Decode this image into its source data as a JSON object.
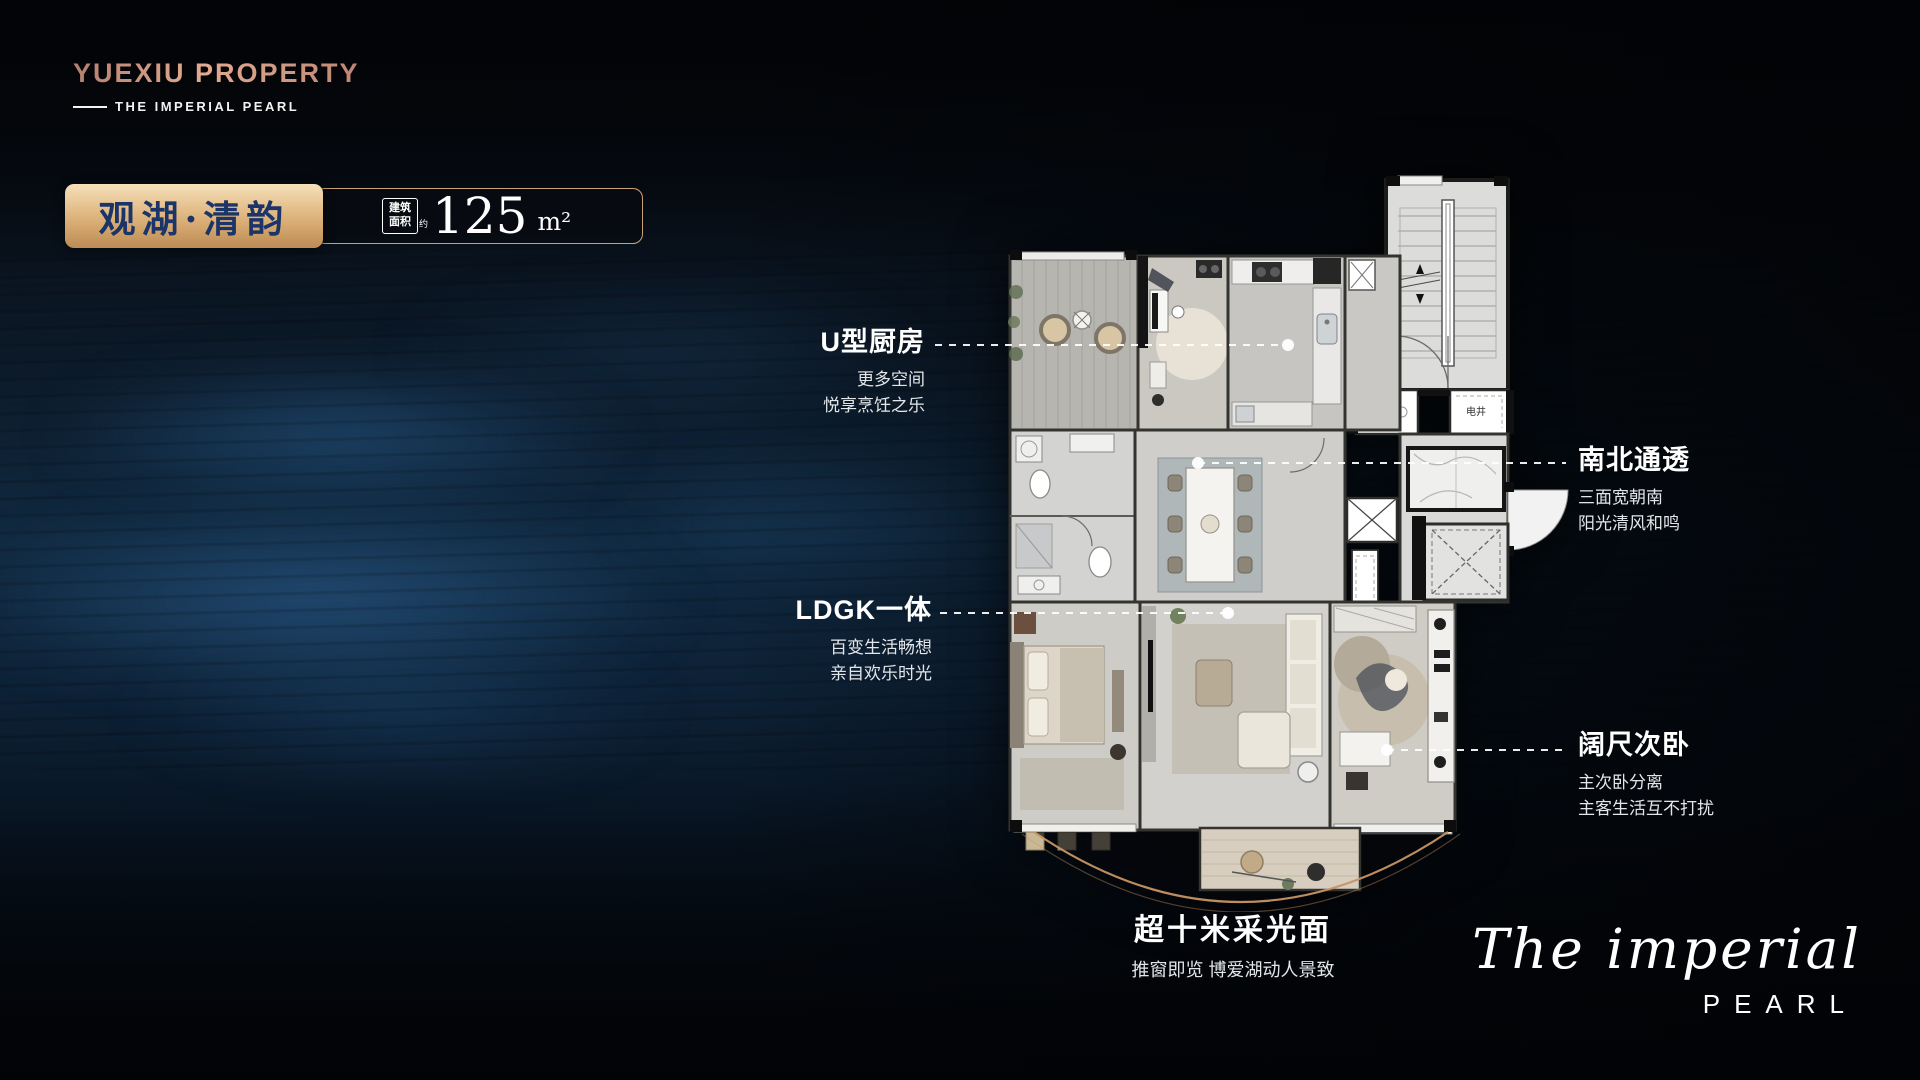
{
  "brand": {
    "name": "YUEXIU PROPERTY",
    "sub": "THE IMPERIAL PEARL"
  },
  "unit": {
    "name": "观湖·清韵",
    "area_label_line1": "建筑",
    "area_label_line2": "面积",
    "area_label_suffix": "约",
    "area_value": "125",
    "area_unit": "m²"
  },
  "callouts": {
    "kitchen": {
      "title": "U型厨房",
      "lines": [
        "更多空间",
        "悦享烹饪之乐"
      ]
    },
    "south_north": {
      "title": "南北通透",
      "lines": [
        "三面宽朝南",
        "阳光清风和鸣"
      ]
    },
    "ldgk": {
      "title": "LDGK一体",
      "lines": [
        "百变生活畅想",
        "亲自欢乐时光"
      ]
    },
    "bedroom": {
      "title": "阔尺次卧",
      "lines": [
        "主次卧分离",
        "主客生活互不打扰"
      ]
    },
    "daylight": {
      "title": "超十米采光面",
      "lines": [
        "推窗即览 博爱湖动人景致"
      ]
    }
  },
  "floorplan": {
    "labels": {
      "water_shaft": "水井",
      "electric_shaft": "电井"
    }
  },
  "signature": {
    "script": "The imperial",
    "caps": "PEARL"
  },
  "colors": {
    "accent_gold": "#d8ab72",
    "navy_text": "#1c3569",
    "water_blue": "#2e6aa3",
    "copper_arc": "#c79464",
    "logo_copper": "#cf937d"
  }
}
